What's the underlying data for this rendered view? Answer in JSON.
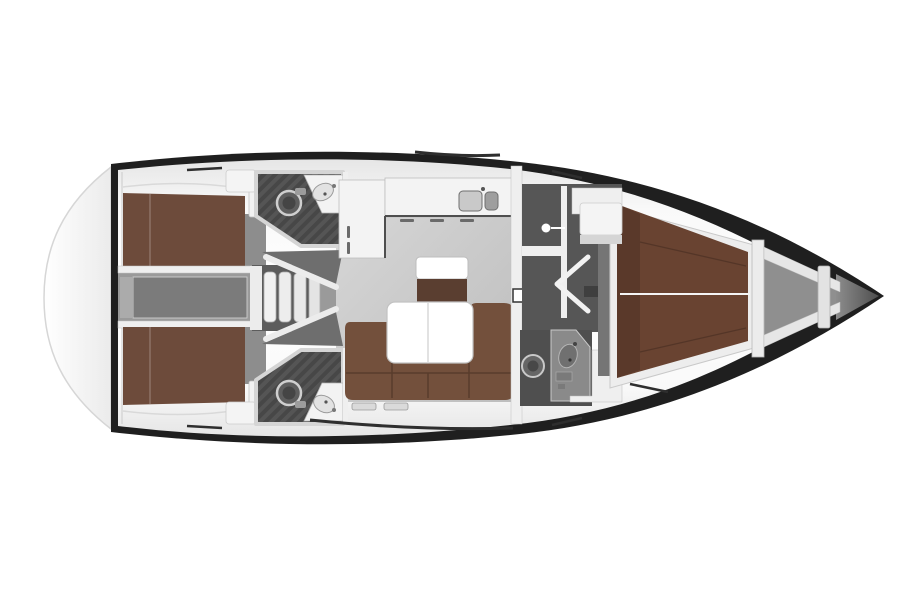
{
  "canvas": {
    "width": 900,
    "height": 600,
    "background": "#ffffff"
  },
  "diagram_type": "sailing-yacht-interior-floor-plan-top-view",
  "regions": [
    "swim-platform",
    "hull",
    "side-deck",
    "aft-cabin-port",
    "aft-cabin-starboard",
    "engine-compartment",
    "companionway-steps",
    "head-aft-port",
    "head-aft-starboard",
    "salon",
    "galley",
    "chart-cabinet",
    "salon-table",
    "salon-sofa",
    "bulkhead",
    "wardrobe-lockers",
    "forward-corridor",
    "cabin-door-open",
    "head-forward",
    "forward-cabin-vberth",
    "anchor-locker",
    "bow"
  ],
  "colors": {
    "background": "#ffffff",
    "hull_outline": "#1f1f1f",
    "transom_line": "#d6d6d6",
    "deck_white": "#f9f9f9",
    "wall_white": "#efefef",
    "door_white": "#f2f2f2",
    "counter_white": "#f3f3f3",
    "table_white": "#ffffff",
    "tread_white": "#f1f1f1",
    "salon_floor": "#c9c9c9",
    "passage_gray": "#9a9a9a",
    "engine_floor": "#9a9a9a",
    "engine_box": "#7b7b7b",
    "steps_well": "#5c5c5c",
    "funnel_dark": "#6e6e6e",
    "head_floor": "#474747",
    "head_stripe": "#555555",
    "locker_dark": "#5b5b5b",
    "corridor_dark": "#565656",
    "entry_strip": "#757575",
    "dresser_gray": "#8d8d8d",
    "fixture_gray": "#8a8a8a",
    "toilet_gray": "#5e5e5e",
    "toilet_inner": "#454545",
    "sink_light": "#c9c9c9",
    "sink_dark": "#9e9e9e",
    "basin_gray": "#707070",
    "berth_aft_brown": "#6d4b3b",
    "berth_fwd_brown": "#694331",
    "sofa_brown": "#73503c",
    "cabinet_brown": "#5a3e30",
    "anchor_gray": "#8f8f8f",
    "bow_cone": "#777777",
    "window_dark": "#2e2e2e",
    "white_block": "#f4f4f4"
  }
}
